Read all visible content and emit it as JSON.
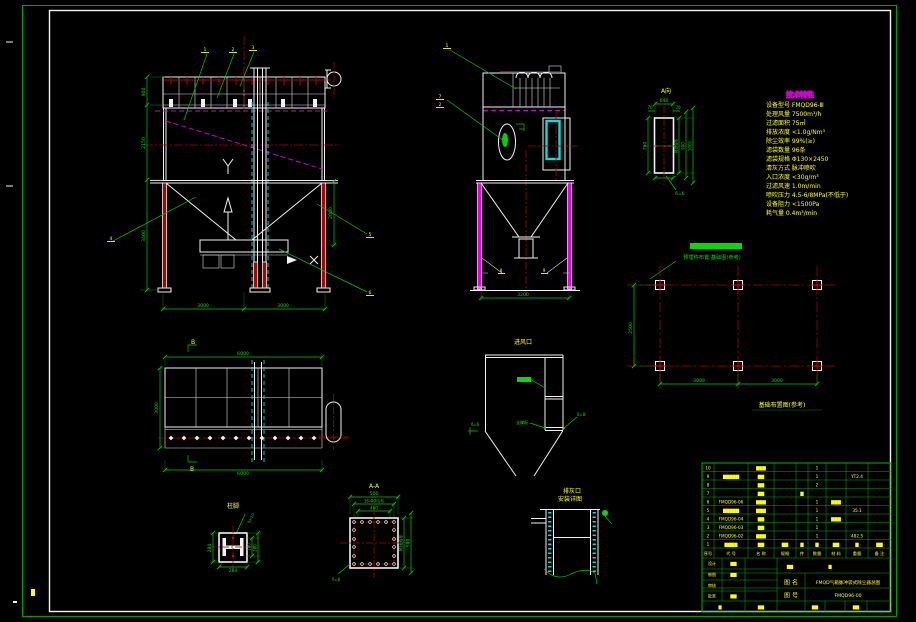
{
  "palette": {
    "background": "#000000",
    "frame_outer_green": "#00a000",
    "frame_inner_white": "#f2f2f2",
    "dimension_green": "#00c800",
    "label_yellow": "#ffff00",
    "centerline_red": "#a50000",
    "leg_fill_red": "#b00000",
    "hidden_magenta": "#cc00cc",
    "leg_fill_magenta": "#e800e8",
    "door_cyan": "#00e0e0"
  },
  "v1": {
    "balloons": {
      "a": "1",
      "b": "2",
      "c": "3",
      "left": "4",
      "r1": "5",
      "r2": "6"
    },
    "dims": {
      "left_top": "900",
      "left_mid": "2150",
      "left_bot": "3400",
      "right": "2000",
      "bot_l": "3000",
      "bot_r": "3000"
    }
  },
  "v2": {
    "balloons": {
      "top": "1",
      "m1": "7",
      "m2": "2",
      "b1": "8",
      "b2": "9"
    },
    "dims": {
      "bot": "3200"
    }
  },
  "va": {
    "title": "A向",
    "dims": {
      "top": "640",
      "top_l": "70",
      "top_r": "70",
      "left": "790",
      "r1": "M8均布",
      "r2": "900",
      "r3": "1000",
      "note": "δ=6"
    }
  },
  "specs": {
    "title": "技术特性",
    "lines": [
      "设备型号 FMQD96-Ⅲ",
      "处理风量 7500m³/h",
      "过滤面积 75㎡",
      "排放浓度 <1.0g/Nm³",
      "除尘效率 99%(≥)",
      "滤袋数量 96条",
      "滤袋规格 Φ130×2450",
      "清灰方式 脉冲喷吹",
      "入口浓度 <30g/m³",
      "过滤风速 1.0m/min",
      "喷吹压力 4.5-6/8MPa(不低于)",
      "设备阻力 <1500Pa",
      "耗气量 0.4m³/min"
    ]
  },
  "fp": {
    "label": "预埋件布置 基础图(参考)",
    "caption": "基础布置图(参考)",
    "dims": {
      "left": "2500",
      "b1": "3000",
      "b2": "3000"
    }
  },
  "v3": {
    "marks": {
      "top": "B",
      "bot": "B"
    },
    "dims": {
      "top": "6000",
      "left": "3000",
      "bot": "6000"
    }
  },
  "d2": {
    "title": "柱脚",
    "note": "δ=10",
    "dims": {
      "left": "280",
      "bot": "280",
      "r1": "180",
      "r2": "280"
    }
  },
  "d3": {
    "title": "A-A",
    "dims": {
      "d1": "500",
      "d2": "16-Φ9均布",
      "d3": "460",
      "r1": "M16均布",
      "r2": "500"
    },
    "note": "δ=8"
  },
  "d4": {
    "title": "进风口",
    "labels": {
      "mid": "支撑板",
      "right": "δ=8",
      "left": "δ=6"
    }
  },
  "d5": {
    "title1": "排灰口",
    "title2": "安装详图"
  },
  "tb": {
    "header": [
      "序号",
      "代 号",
      "名 称",
      "规格",
      "件",
      "数量",
      "材 料",
      "重量",
      "备 注"
    ],
    "rows": [
      {
        "seq": "10",
        "name": "▇▇▇",
        "qty": "1"
      },
      {
        "seq": "9",
        "code": "▇▇▇▇▇",
        "name": "▇▇",
        "qty": "1",
        "wt": "YT2.4"
      },
      {
        "seq": "8",
        "name": "▇▇",
        "qty": "2"
      },
      {
        "seq": "7",
        "name": "▇▇",
        "c5": "▇"
      },
      {
        "seq": "6",
        "code": "FMQD96-06",
        "name": "▇▇▇",
        "qty": "1",
        "mat": "▇▇▇"
      },
      {
        "seq": "5",
        "code": "▇▇▇▇▇",
        "name": "▇▇▇",
        "qty": "1",
        "wt": "35.1"
      },
      {
        "seq": "4",
        "code": "FMQD96-04",
        "name": "▇▇",
        "qty": "1",
        "mat": "▇▇▇"
      },
      {
        "seq": "3",
        "code": "FMQD96-03",
        "name": "▇▇",
        "qty": "1"
      },
      {
        "seq": "2",
        "code": "FMQD96-02",
        "name": "▇▇▇",
        "qty": "1",
        "wt": "482.5"
      },
      {
        "seq": "1",
        "code": "▇▇▇▇",
        "name": "▇▇",
        "spec": "▇▇",
        "c5": "▇",
        "qty": "▇",
        "mat": "▇▇",
        "wt": "▇",
        "note": "▇▇"
      }
    ],
    "name_label": "图 名",
    "name_value": "FMQD气箱脉冲袋式除尘器总图",
    "no_label": "图 号",
    "no_value": "FMQD96-00",
    "left_labels": [
      "设计",
      "制图",
      "审核",
      "批准"
    ],
    "left_vals": [
      "▇▇",
      "▇▇",
      "",
      "▇▇"
    ],
    "extras": [
      "▇▇",
      "▇"
    ],
    "bottom_bits": [
      "▇",
      "▇▇",
      "▇▇",
      "▇▇"
    ]
  }
}
